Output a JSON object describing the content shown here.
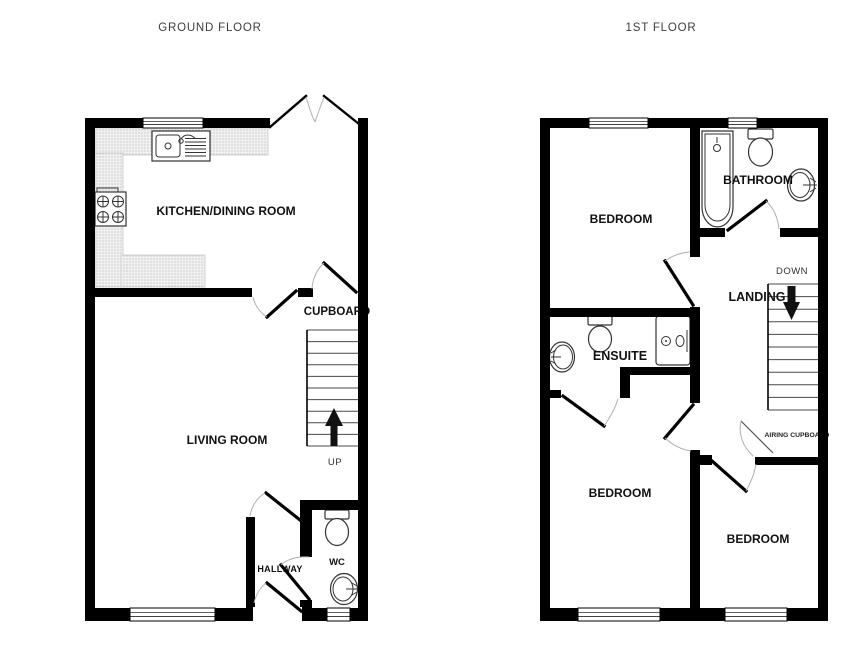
{
  "colors": {
    "wall": "#000000",
    "counter_dot": "#9a9a9a",
    "counter_bg": "#f1f1f1",
    "swing_arc": "#b0b0b0",
    "arrow": "#111111",
    "text": "#111111"
  },
  "ground_floor": {
    "title": "GROUND FLOOR",
    "rooms": {
      "kitchen_dining": "KITCHEN/DINING ROOM",
      "living_room": "LIVING ROOM",
      "cupboard": "CUPBOARD",
      "hallway": "HALLWAY",
      "wc": "WC"
    },
    "stairs_label": "UP",
    "fixtures": [
      "kitchen-sink-drainer",
      "hob",
      "toilet",
      "basin"
    ]
  },
  "first_floor": {
    "title": "1ST FLOOR",
    "rooms": {
      "bedroom_front": "BEDROOM",
      "bathroom": "BATHROOM",
      "ensuite": "ENSUITE",
      "landing": "LANDING",
      "bedroom_rear_left": "BEDROOM",
      "bedroom_rear_right": "BEDROOM",
      "airing_cupboard": "AIRING CUPBOARD"
    },
    "stairs_label": "DOWN",
    "fixtures": [
      "bath",
      "toilet",
      "basin",
      "shower",
      "toilet",
      "basin"
    ]
  }
}
